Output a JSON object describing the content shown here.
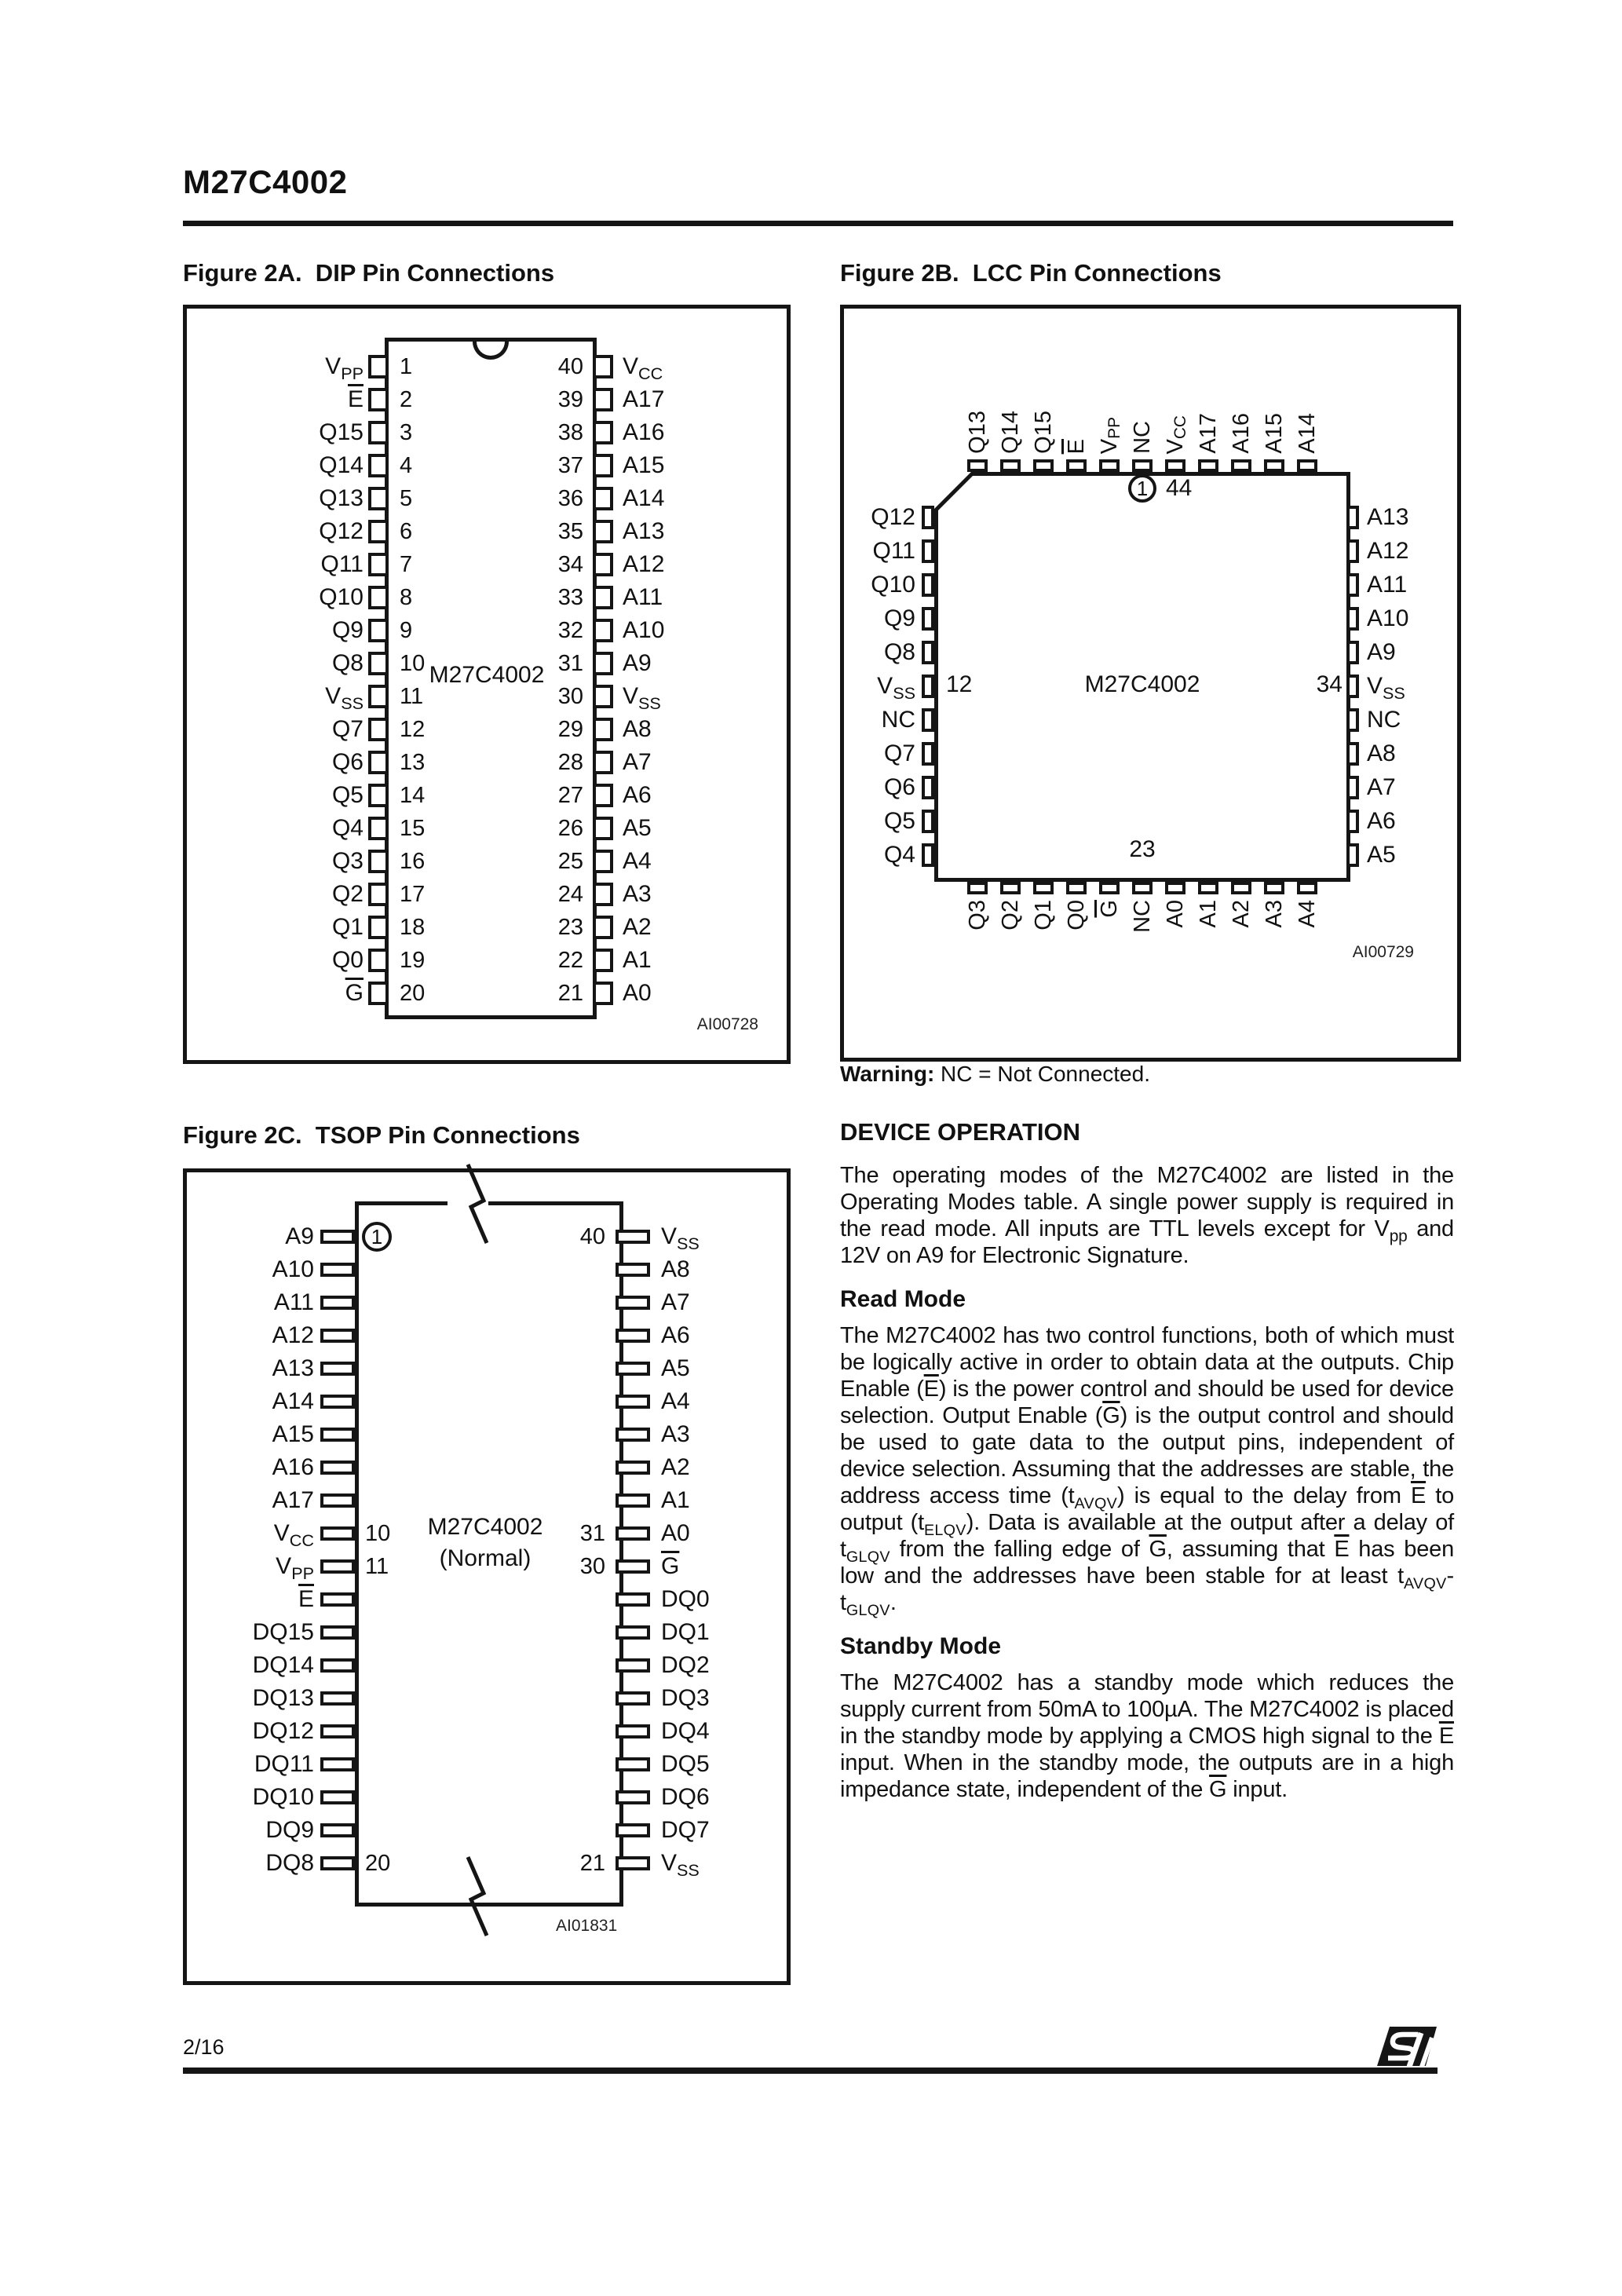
{
  "header": {
    "title": "M27C4002"
  },
  "figures": {
    "dip": {
      "caption": "Figure 2A.  DIP Pin Connections",
      "chip_label": "M27C4002",
      "drawing_code": "AI00728",
      "rows": [
        {
          "ll": "V<sub class=\"vs\">PP</sub>",
          "ln": "1",
          "rn": "40",
          "rl": "V<sub class=\"vs\">CC</sub>"
        },
        {
          "ll": "<span class=\"ov\">E</span>",
          "ln": "2",
          "rn": "39",
          "rl": "A17"
        },
        {
          "ll": "Q15",
          "ln": "3",
          "rn": "38",
          "rl": "A16"
        },
        {
          "ll": "Q14",
          "ln": "4",
          "rn": "37",
          "rl": "A15"
        },
        {
          "ll": "Q13",
          "ln": "5",
          "rn": "36",
          "rl": "A14"
        },
        {
          "ll": "Q12",
          "ln": "6",
          "rn": "35",
          "rl": "A13"
        },
        {
          "ll": "Q11",
          "ln": "7",
          "rn": "34",
          "rl": "A12"
        },
        {
          "ll": "Q10",
          "ln": "8",
          "rn": "33",
          "rl": "A11"
        },
        {
          "ll": "Q9",
          "ln": "9",
          "rn": "32",
          "rl": "A10"
        },
        {
          "ll": "Q8",
          "ln": "10",
          "rn": "31",
          "rl": "A9"
        },
        {
          "ll": "V<sub class=\"vs\">SS</sub>",
          "ln": "11",
          "rn": "30",
          "rl": "V<sub class=\"vs\">SS</sub>"
        },
        {
          "ll": "Q7",
          "ln": "12",
          "rn": "29",
          "rl": "A8"
        },
        {
          "ll": "Q6",
          "ln": "13",
          "rn": "28",
          "rl": "A7"
        },
        {
          "ll": "Q5",
          "ln": "14",
          "rn": "27",
          "rl": "A6"
        },
        {
          "ll": "Q4",
          "ln": "15",
          "rn": "26",
          "rl": "A5"
        },
        {
          "ll": "Q3",
          "ln": "16",
          "rn": "25",
          "rl": "A4"
        },
        {
          "ll": "Q2",
          "ln": "17",
          "rn": "24",
          "rl": "A3"
        },
        {
          "ll": "Q1",
          "ln": "18",
          "rn": "23",
          "rl": "A2"
        },
        {
          "ll": "Q0",
          "ln": "19",
          "rn": "22",
          "rl": "A1"
        },
        {
          "ll": "<span class=\"ov\">G</span>",
          "ln": "20",
          "rn": "21",
          "rl": "A0"
        }
      ]
    },
    "lcc": {
      "caption": "Figure 2B.  LCC Pin Connections",
      "chip_label": "M27C4002",
      "drawing_code": "AI00729",
      "pin1_circle": "1",
      "pin44": "44",
      "left_num": "12",
      "right_num": "34",
      "bottom_num": "23",
      "top": [
        "Q13",
        "Q14",
        "Q15",
        "<span class=\"ov\">E</span>",
        "V<sub class=\"vs\">PP</sub>",
        "NC",
        "V<sub class=\"vs\">CC</sub>",
        "A17",
        "A16",
        "A15",
        "A14"
      ],
      "bottom": [
        "Q3",
        "Q2",
        "Q1",
        "Q0",
        "<span class=\"ov\">G</span>",
        "NC",
        "A0",
        "A1",
        "A2",
        "A3",
        "A4"
      ],
      "rows": [
        {
          "ll": "Q12",
          "rl": "A13"
        },
        {
          "ll": "Q11",
          "rl": "A12"
        },
        {
          "ll": "Q10",
          "rl": "A11"
        },
        {
          "ll": "Q9",
          "rl": "A10"
        },
        {
          "ll": "Q8",
          "rl": "A9"
        },
        {
          "ll": "V<sub class=\"vs\">SS</sub>",
          "rl": "V<sub class=\"vs\">SS</sub>"
        },
        {
          "ll": "NC",
          "rl": "NC"
        },
        {
          "ll": "Q7",
          "rl": "A8"
        },
        {
          "ll": "Q6",
          "rl": "A7"
        },
        {
          "ll": "Q5",
          "rl": "A6"
        },
        {
          "ll": "Q4",
          "rl": "A5"
        }
      ],
      "warning_label": "Warning:",
      "warning_text": " NC = Not Connected."
    },
    "tsop": {
      "caption": "Figure 2C.  TSOP Pin Connections",
      "chip_label": "M27C4002",
      "chip_sublabel": "(Normal)",
      "drawing_code": "AI01831",
      "rows": [
        {
          "ll": "A9",
          "ln": "1",
          "lc": true,
          "rn": "40",
          "rl": "V<sub class=\"vs\">SS</sub>"
        },
        {
          "ll": "A10",
          "rl": "A8"
        },
        {
          "ll": "A11",
          "rl": "A7"
        },
        {
          "ll": "A12",
          "rl": "A6"
        },
        {
          "ll": "A13",
          "rl": "A5"
        },
        {
          "ll": "A14",
          "rl": "A4"
        },
        {
          "ll": "A15",
          "rl": "A3"
        },
        {
          "ll": "A16",
          "rl": "A2"
        },
        {
          "ll": "A17",
          "rl": "A1"
        },
        {
          "ll": "V<sub class=\"vs\">CC</sub>",
          "ln": "10",
          "rn": "31",
          "rl": "A0"
        },
        {
          "ll": "V<sub class=\"vs\">PP</sub>",
          "ln": "11",
          "rn": "30",
          "rl": "<span class=\"ov\">G</span>"
        },
        {
          "ll": "<span class=\"ov\">E</span>",
          "rl": "DQ0"
        },
        {
          "ll": "DQ15",
          "rl": "DQ1"
        },
        {
          "ll": "DQ14",
          "rl": "DQ2"
        },
        {
          "ll": "DQ13",
          "rl": "DQ3"
        },
        {
          "ll": "DQ12",
          "rl": "DQ4"
        },
        {
          "ll": "DQ11",
          "rl": "DQ5"
        },
        {
          "ll": "DQ10",
          "rl": "DQ6"
        },
        {
          "ll": "DQ9",
          "rl": "DQ7"
        },
        {
          "ll": "DQ8",
          "ln": "20",
          "rn": "21",
          "rl": "V<sub class=\"vs\">SS</sub>"
        }
      ]
    }
  },
  "article": {
    "heading": "DEVICE OPERATION",
    "para1": "The operating modes of the M27C4002 are listed in the Operating Modes table. A single power supply is required in the read mode.  All inputs are TTL levels except for V<sub class=\"vs\">pp</sub> and 12V on A9 for Electronic Signature.",
    "read_heading": "Read Mode",
    "para2": "The M27C4002 has two control functions, both of which must be logically active in order to obtain data at the outputs.  Chip Enable (<span class=\"ov\">E</span>) is the power control and should be used for device selection. Output Enable (<span class=\"ov\">G</span>) is the output control and should be used to gate data to the output pins, independent of device selection.  Assuming that the addresses are stable, the address access time (t<sub class=\"ts\">AVQV</sub>) is equal to the delay from <span class=\"ov\">E</span> to output (t<sub class=\"ts\">ELQV</sub>). Data is available at the output after a delay of t<sub class=\"ts\">GLQV</sub> from the falling edge of <span class=\"ov\">G</span>, assuming that <span class=\"ov\">E</span> has been low and the addresses have been stable for at least t<sub class=\"ts\">AVQV</sub>-t<sub class=\"ts\">GLQV</sub>.",
    "standby_heading": "Standby Mode",
    "para3": "The M27C4002 has a standby mode which reduces the supply current from 50mA to 100µA. The M27C4002 is placed in the standby mode by applying a CMOS high signal to the <span class=\"ov\">E</span> input.  When in the standby mode, the outputs are in a high impedance state, independent of the <span class=\"ov\">G</span> input."
  },
  "footer": {
    "page_number": "2/16"
  }
}
